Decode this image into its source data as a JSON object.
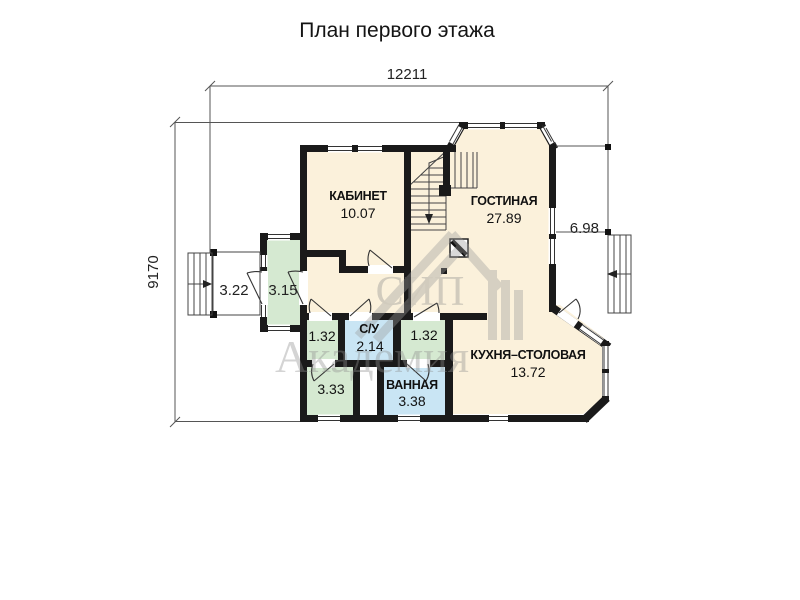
{
  "title": "План первого этажа",
  "dimensions": {
    "width_top": "12211",
    "height_left": "9170",
    "right_offset": "6.98"
  },
  "rooms": {
    "kabinet": {
      "name": "КАБИНЕТ",
      "area": "10.07"
    },
    "gostinaya": {
      "name": "ГОСТИНАЯ",
      "area": "27.89"
    },
    "kuhnya": {
      "name": "КУХНЯ–СТОЛОВАЯ",
      "area": "13.72"
    },
    "su": {
      "name": "С/У",
      "area": "2.14"
    },
    "vannaya": {
      "name": "ВАННАЯ",
      "area": "3.38"
    },
    "tambour": {
      "area": "3.15"
    },
    "porch": {
      "area": "3.22"
    },
    "hall_left": {
      "area": "1.32"
    },
    "hall_right": {
      "area": "1.32"
    },
    "storage": {
      "area": "3.33"
    }
  },
  "watermark": {
    "line1": "СИП",
    "line2": "Академия"
  },
  "colors": {
    "room_beige": "#fbf1db",
    "room_green": "#d5e9d1",
    "room_blue": "#c9e5f4",
    "wall": "#1a1a1a"
  }
}
